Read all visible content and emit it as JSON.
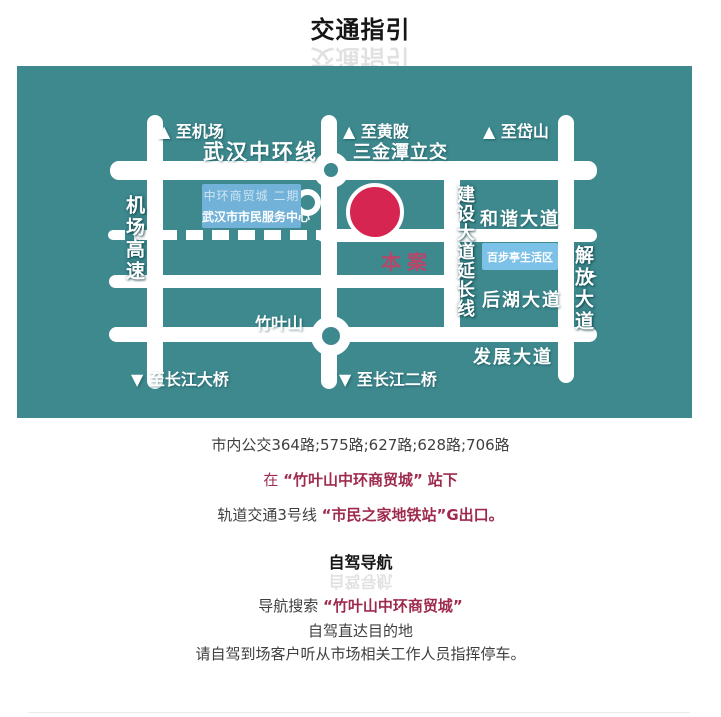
{
  "page": {
    "title": "交通指引"
  },
  "map": {
    "colors": {
      "background": "#3d898e",
      "road": "#ffffff",
      "site_marker": "#d62550",
      "site_label": "#b5486a",
      "mall_box": "#72b2d8",
      "baibuting_box": "#7cc1e8"
    },
    "labels": {
      "to_airport": "▲ 至机场",
      "zhonghuan_ring_road": "武汉中环线",
      "to_huangpi": "▲ 至黄陂",
      "sanjintan_interchange": "三金潭立交",
      "to_daishan": "▲ 至岱山",
      "airport_expressway": "机场高速",
      "hexie_avenue": "和谐大道",
      "jianshe_avenue_extension": "建设大道延长线",
      "jiefang_avenue": "解放大道",
      "jiefang_arrow": "►",
      "houhu_avenue": "后湖大道",
      "fazhan_avenue": "发展大道",
      "zhuyeshan": "竹叶山",
      "to_changjiang_bridge": "▼ 至长江大桥",
      "to_changjiang_second_bridge": "▼ 至长江二桥",
      "site": "本案",
      "mall_phase2": "中环商贸城 二期",
      "citizen_service_center": "武汉市市民服务中心",
      "baibuting_area": "百步亭生活区"
    }
  },
  "transit": {
    "bus_routes": "市内公交364路;575路;627路;628路;706路",
    "stop_prefix": "在",
    "stop_highlight": "“竹叶山中环商贸城”",
    "stop_suffix": "站下",
    "metro_prefix": "轨道交通3号线",
    "metro_highlight": "“市民之家地铁站”G出口。"
  },
  "driving": {
    "heading": "自驾导航",
    "search_prefix": "导航搜索",
    "search_highlight": "“竹叶山中环商贸城”",
    "direct_line": "自驾直达目的地",
    "parking_line": "请自驾到场客户听从市场相关工作人员指挥停车。"
  }
}
